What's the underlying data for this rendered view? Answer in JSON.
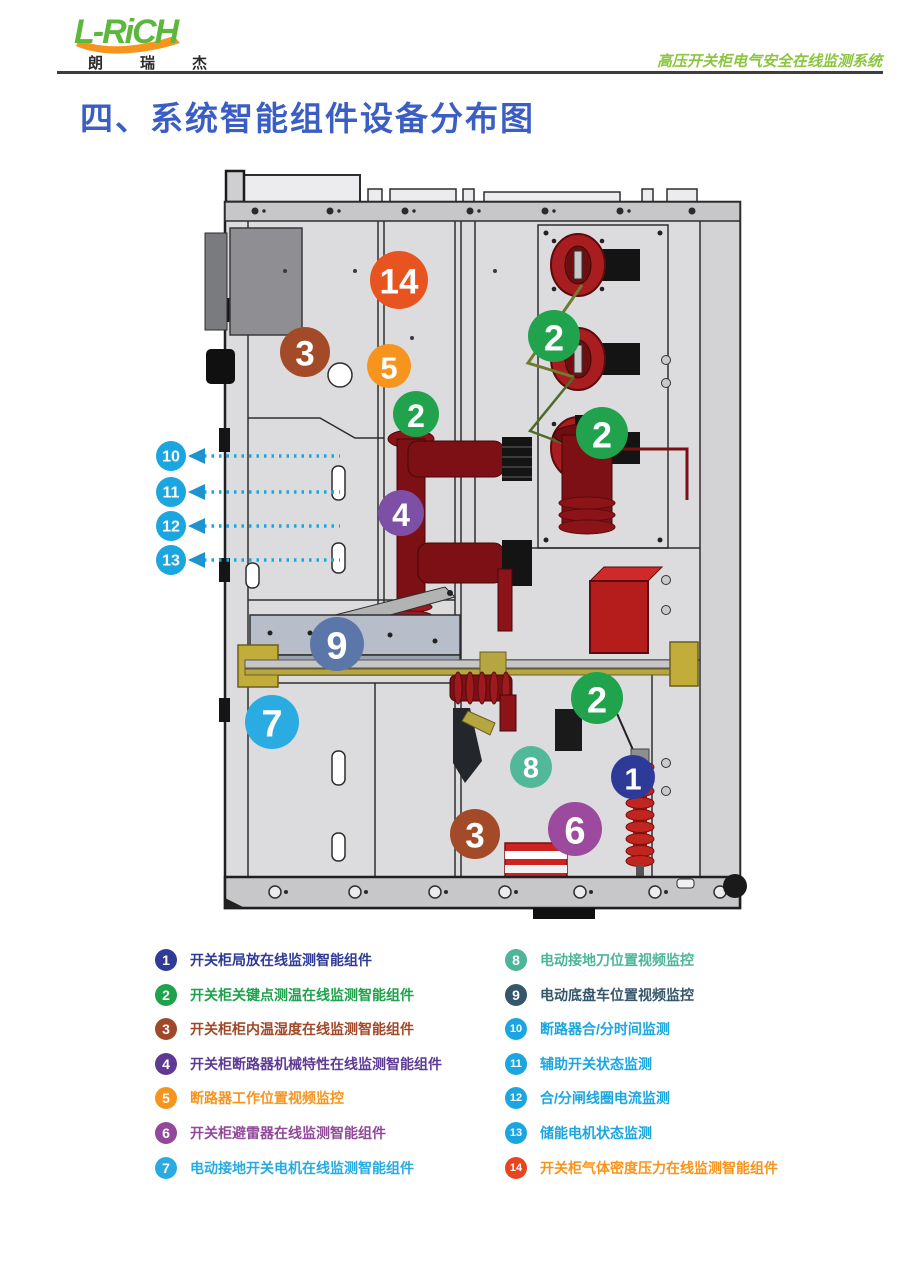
{
  "header": {
    "logo_text": "L-RiCH",
    "logo_sub": "朗瑞杰",
    "tagline": "高压开关柜电气安全在线监测系统"
  },
  "title": "四、系统智能组件设备分布图",
  "legend": {
    "left": [
      {
        "num": "1",
        "label": "开关柜局放在线监测智能组件",
        "color": "#2f3b96"
      },
      {
        "num": "2",
        "label": "开关柜关键点测温在线监测智能组件",
        "color": "#1ea24b"
      },
      {
        "num": "3",
        "label": "开关柜柜内温湿度在线监测智能组件",
        "color": "#a0492a"
      },
      {
        "num": "4",
        "label": "开关柜断路器机械特性在线监测智能组件",
        "color": "#5f3a94"
      },
      {
        "num": "5",
        "label": "断路器工作位置视频监控",
        "color": "#f7941d"
      },
      {
        "num": "6",
        "label": "开关柜避雷器在线监测智能组件",
        "color": "#93489c"
      },
      {
        "num": "7",
        "label": "电动接地开关电机在线监测智能组件",
        "color": "#29abe2"
      }
    ],
    "right": [
      {
        "num": "8",
        "label": "电动接地刀位置视频监控",
        "color": "#4db598"
      },
      {
        "num": "9",
        "label": "电动底盘车位置视频监控",
        "color": "#35566b"
      },
      {
        "num": "10",
        "label": "断路器合/分时间监测",
        "color": "#1ca6e0"
      },
      {
        "num": "11",
        "label": "辅助开关状态监测",
        "color": "#1ca6e0"
      },
      {
        "num": "12",
        "label": "合/分闸线圈电流监测",
        "color": "#1ca6e0"
      },
      {
        "num": "13",
        "label": "储能电机状态监测",
        "color": "#1ca6e0"
      },
      {
        "num": "14",
        "label": "开关柜气体密度压力在线监测智能组件",
        "color": "#e8441f",
        "text_color": "#f7941d"
      }
    ]
  },
  "diagram": {
    "markers": [
      {
        "num": "14",
        "x": 249,
        "y": 117,
        "r": 29,
        "color": "#e8541f"
      },
      {
        "num": "3",
        "x": 155,
        "y": 189,
        "r": 25,
        "color": "#a34b28"
      },
      {
        "num": "5",
        "x": 239,
        "y": 203,
        "r": 22,
        "color": "#f7941d"
      },
      {
        "num": "2",
        "x": 266,
        "y": 251,
        "r": 23,
        "color": "#21a24c"
      },
      {
        "num": "2",
        "x": 404,
        "y": 173,
        "r": 26,
        "color": "#21a24c"
      },
      {
        "num": "2",
        "x": 452,
        "y": 270,
        "r": 26,
        "color": "#21a24c"
      },
      {
        "num": "4",
        "x": 251,
        "y": 350,
        "r": 23,
        "color": "#7d50a5"
      },
      {
        "num": "9",
        "x": 187,
        "y": 481,
        "r": 27,
        "color": "#5b76a8"
      },
      {
        "num": "7",
        "x": 122,
        "y": 559,
        "r": 27,
        "color": "#2aabe2"
      },
      {
        "num": "2",
        "x": 447,
        "y": 535,
        "r": 26,
        "color": "#21a24c"
      },
      {
        "num": "8",
        "x": 381,
        "y": 604,
        "r": 21,
        "color": "#52b89a"
      },
      {
        "num": "1",
        "x": 483,
        "y": 614,
        "r": 22,
        "color": "#2e3a97"
      },
      {
        "num": "6",
        "x": 425,
        "y": 666,
        "r": 27,
        "color": "#9b4a9e"
      },
      {
        "num": "3",
        "x": 325,
        "y": 671,
        "r": 25,
        "color": "#a34b28"
      }
    ],
    "arrows": [
      {
        "num": "10",
        "y": 293
      },
      {
        "num": "11",
        "y": 329
      },
      {
        "num": "12",
        "y": 363
      },
      {
        "num": "13",
        "y": 397
      }
    ],
    "arrow_color": "#1ca6e0",
    "arrowhead_color": "#1f93cf"
  }
}
